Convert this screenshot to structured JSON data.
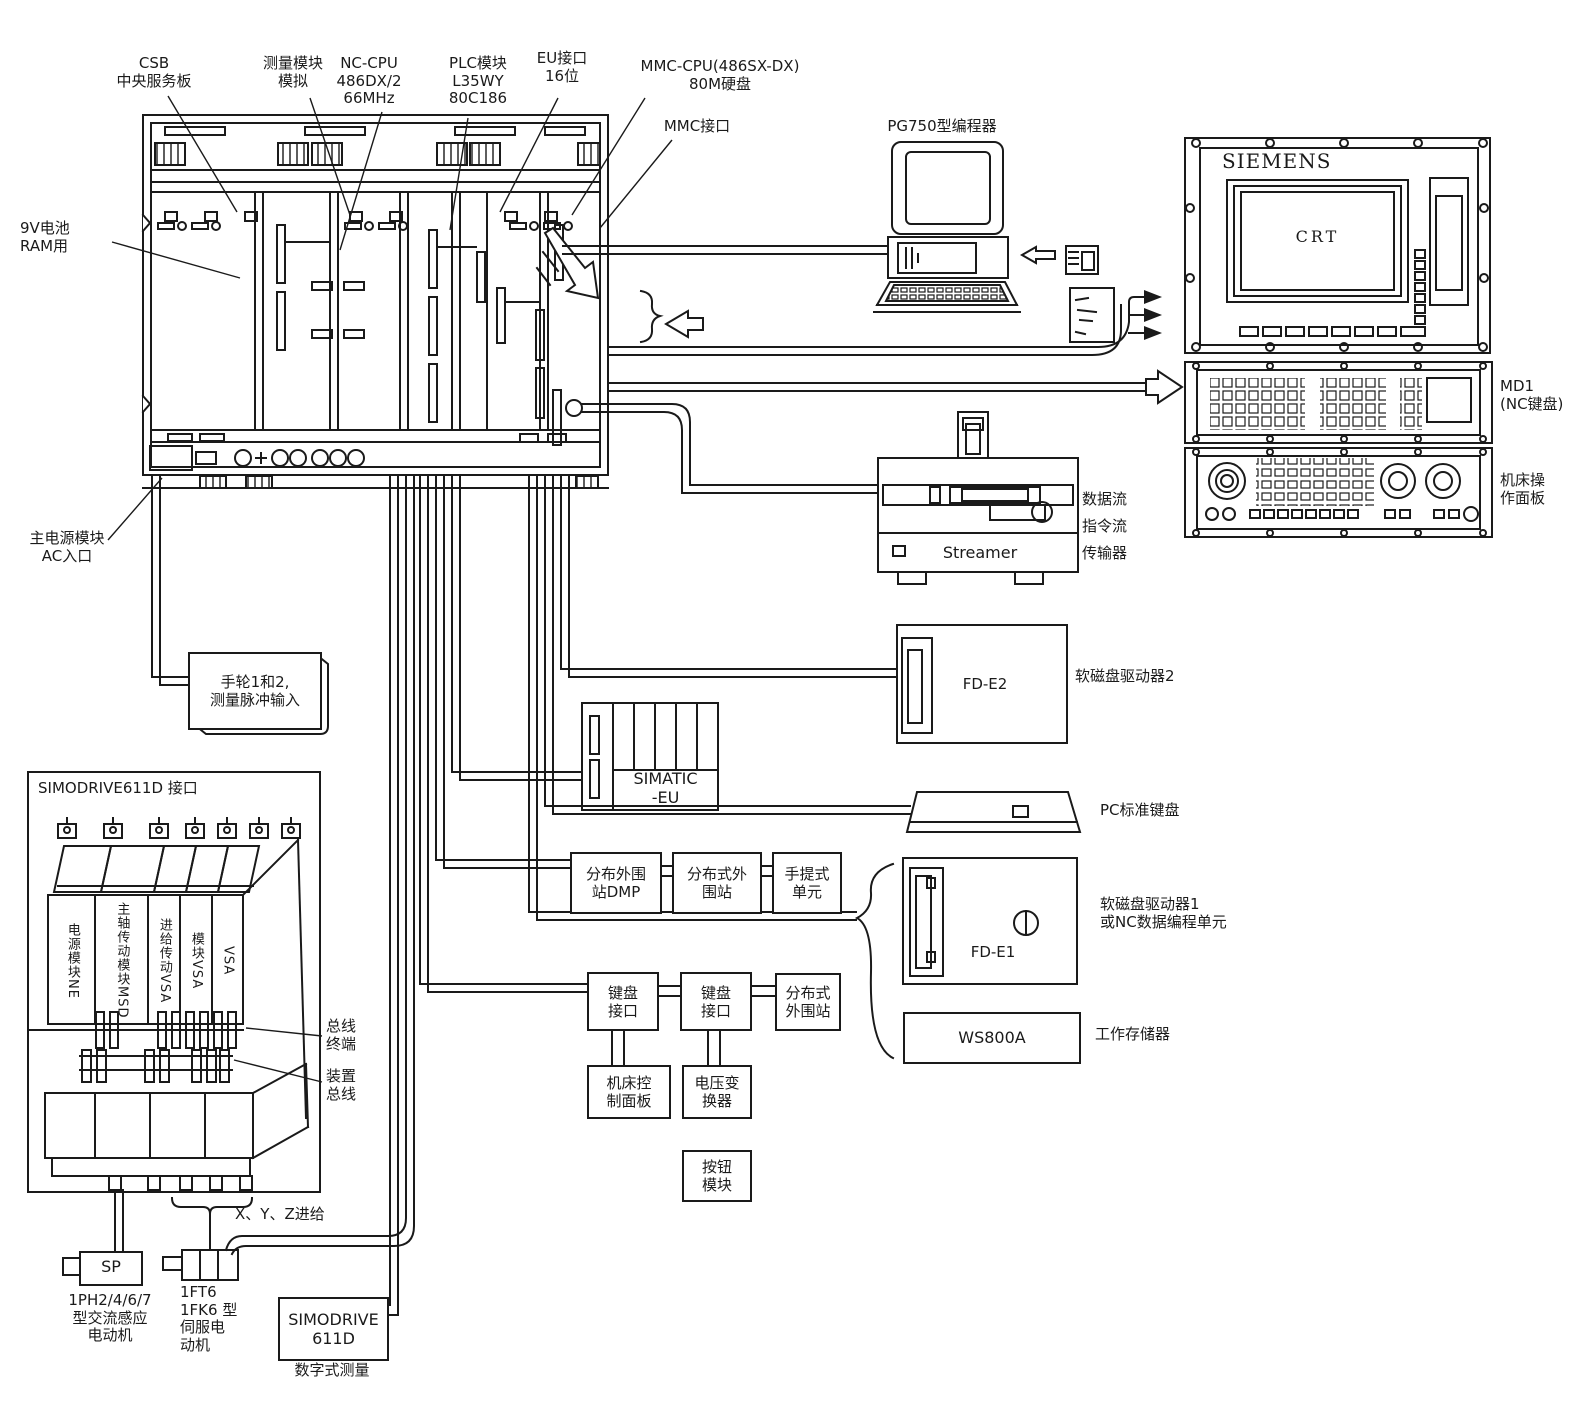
{
  "callouts": {
    "csb": "CSB\n中央服务板",
    "measure_module": "测量模块\n模拟",
    "nc_cpu": "NC-CPU\n486DX/2\n66MHz",
    "plc_module": "PLC模块\nL35WY\n80C186",
    "eu_interface": "EU接口\n16位",
    "mmc_cpu": "MMC-CPU(486SX-DX)\n80M硬盘",
    "mmc_interface": "MMC接口",
    "battery": "9V电池\nRAM用",
    "power_entry": "主电源模块\nAC入口",
    "pg750": "PG750型编程器"
  },
  "right_panels": {
    "brand": "SIEMENS",
    "crt": "CRT",
    "md1": "MD1\n(NC键盘)",
    "machine_panel": "机床操\n作面板"
  },
  "devices": {
    "streamer": "Streamer",
    "data_flow": "数据流\n指令流\n传输器",
    "fd_e2": "FD-E2",
    "floppy_drive2": "软磁盘驱动器2",
    "pc_keyboard": "PC标准键盘",
    "fd_e1": "FD-E1",
    "floppy_drive1": "软磁盘驱动器1\n或NC数据编程单元",
    "ws800a": "WS800A",
    "work_memory": "工作存储器"
  },
  "stations": {
    "simatic_eu": "SIMATIC\n-EU",
    "dmp": "分布外围\n站DMP",
    "dist_station": "分布式外\n围站",
    "handheld": "手提式\n单元",
    "kb_if1": "键盘\n接口",
    "kb_if2": "键盘\n接口",
    "dist_station2": "分布式\n外围站",
    "machine_ctrl": "机床控\n制面板",
    "volt_conv": "电压变\n换器",
    "button_module": "按钮\n模块",
    "handwheel": "手轮1和2,\n测量脉冲输入"
  },
  "drives": {
    "interface": "SIMODRIVE611D 接口",
    "power_module": "电源模块NE",
    "spindle_module": "主轴传动模块MSD",
    "feed_module": "进给传动VSA",
    "module_vsa": "模块VSA",
    "vsa": "VSA",
    "bus_terminal": "总线\n终端",
    "device_bus": "装置\n总线"
  },
  "bottom": {
    "xyz_feed": "X、Y、Z进给",
    "sp": "SP",
    "ac_motor": "1PH2/4/6/7\n型交流感应\n电动机",
    "servo_motor": "1FT6\n1FK6 型\n伺服电\n动机",
    "simodrive": "SIMODRIVE\n611D",
    "digital_measure": "数字式测量"
  }
}
